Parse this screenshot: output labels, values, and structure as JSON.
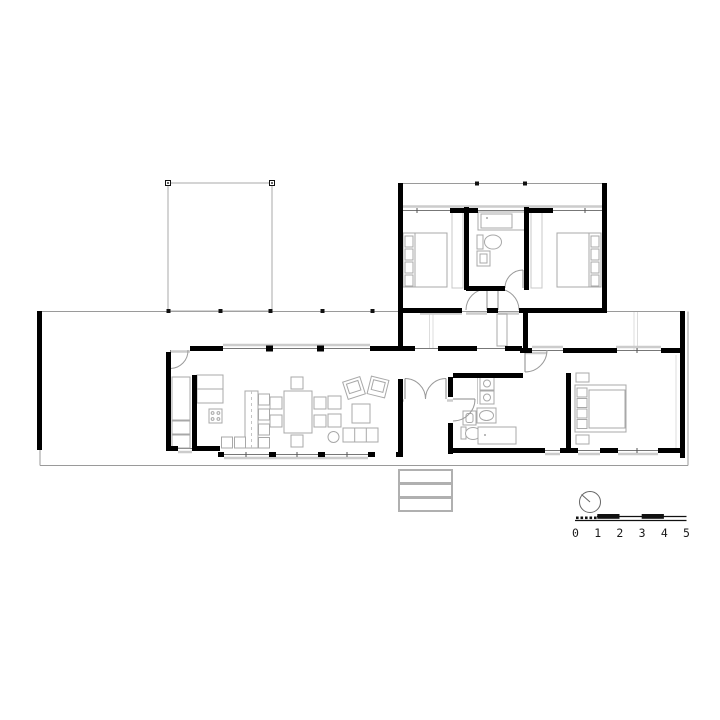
{
  "document": {
    "type": "architectural-floor-plan",
    "background": "#ffffff"
  },
  "scale_bar": {
    "labels": [
      "0",
      "1",
      "2",
      "3",
      "4",
      "5"
    ]
  },
  "colors": {
    "wall": "#000000",
    "outline": "#9a9a9a",
    "furniture": "#a8a8a8",
    "glazing": "#777777",
    "sill": "#cccccc",
    "post": "#111111",
    "compass": "#666666",
    "text": "#1a1a1a"
  },
  "icons": {
    "north_indicator": "north-indicator-icon",
    "scale_bar": "scale-bar"
  }
}
